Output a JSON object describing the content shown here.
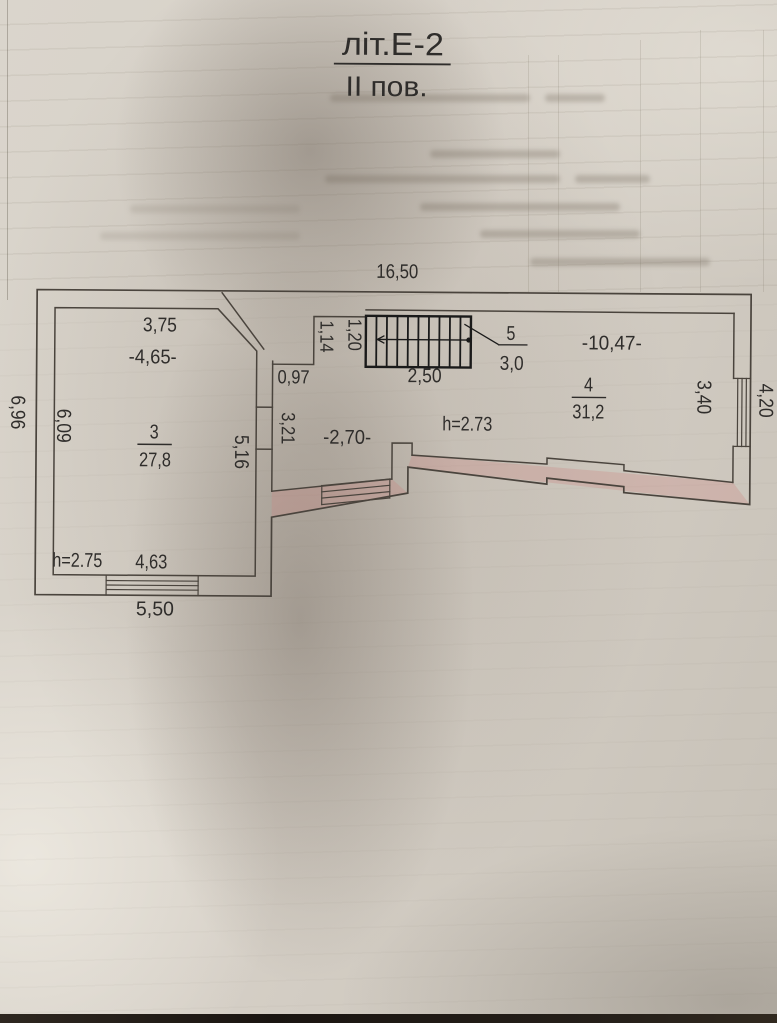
{
  "photo": {
    "paper_color": "#d6d0c7",
    "line_color": "#4a443d",
    "stairs_color": "#1a1a1a",
    "text_color": "#2f2d2b",
    "wall_highlight_color": "rgba(206,130,125,0.28)",
    "bottom_edge_color": "#1a1511"
  },
  "title": {
    "line1": "літ.Е-2",
    "line2": "ІІ пов."
  },
  "plan": {
    "dim_top": "16,50",
    "outer": {
      "left": "6,96",
      "bottom_left": "5,50",
      "right": "4,20"
    },
    "room3": {
      "number": "3",
      "area": "27,8",
      "ceiling": "h=2.75",
      "top": "3,75",
      "top_overall": "-4,65-",
      "left": "6,09",
      "right_wall": "5,16",
      "bottom": "4,63"
    },
    "room4": {
      "number": "4",
      "area": "31,2",
      "width": "-10,47-",
      "right": "3,40"
    },
    "room5": {
      "number": "5",
      "area": "3,0"
    },
    "stairs": {
      "length": "2,50",
      "width": "1,20"
    },
    "hall": {
      "width": "-2,70-",
      "ceiling": "h=2.73",
      "left": "3,21",
      "recess_width": "0,97",
      "recess_height": "1,14"
    }
  }
}
